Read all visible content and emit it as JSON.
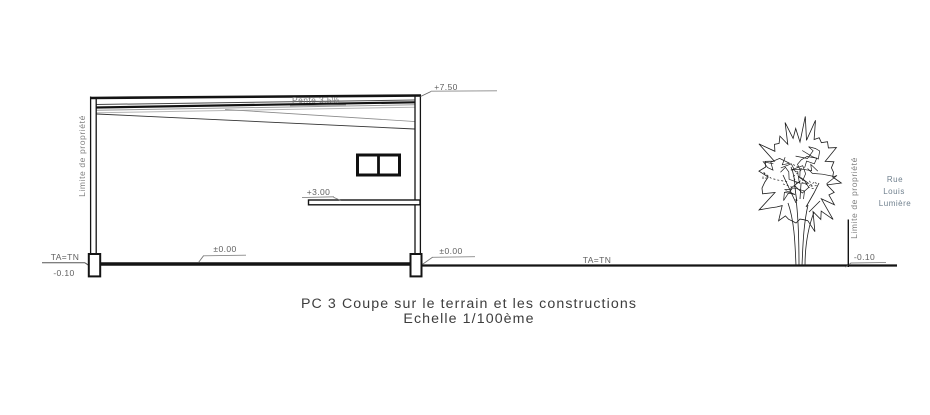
{
  "caption": {
    "line1": "PC 3 Coupe sur le terrain et les constructions",
    "line2": "Echelle 1/100ème"
  },
  "building": {
    "roof_slope_label": "Pente 3.5%",
    "levels": {
      "top": "+7.50",
      "floor": "+3.00",
      "ground_left": "±0.00",
      "ground_right": "±0.00"
    }
  },
  "terrain": {
    "ta_tn_left": "TA=TN",
    "ta_tn_mid": "TA=TN",
    "minus_left": "-0.10",
    "minus_right": "-0.10"
  },
  "property": {
    "left_label": "Limite de propriété",
    "right_label": "Limite de propriété"
  },
  "street": {
    "line1": "Rue",
    "line2": "Louis",
    "line3": "Lumière"
  },
  "colors": {
    "line": "#1a1a1a",
    "gray_line": "#9a9a9a",
    "label": "#5f5f5f",
    "street_text": "#70808e",
    "caption": "#3d3d3d"
  }
}
